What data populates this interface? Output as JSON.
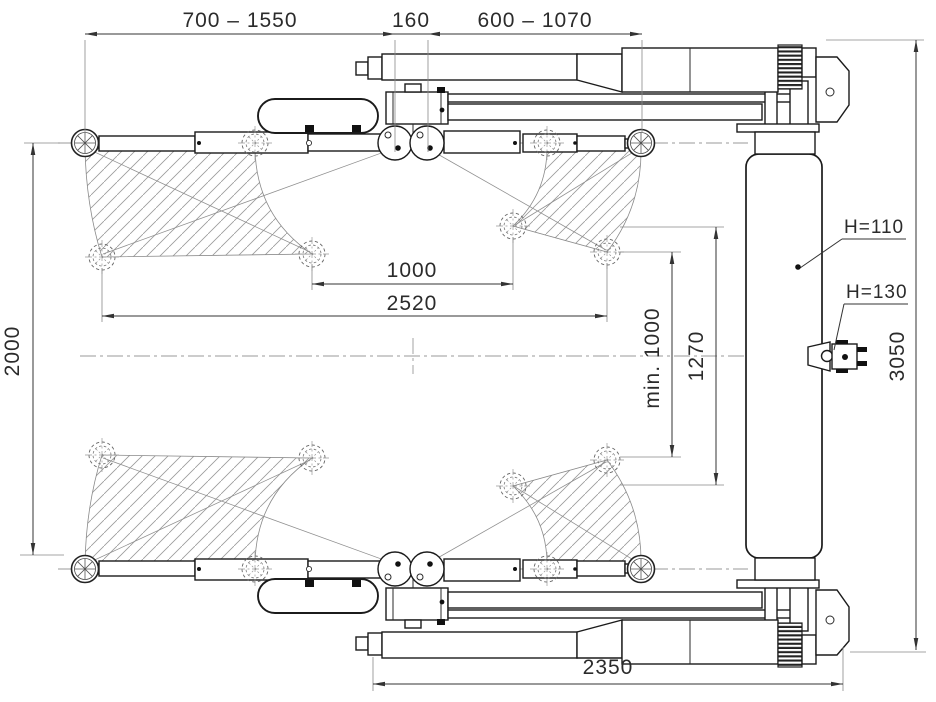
{
  "dimensions": {
    "arm_reach_long": "700 – 1550",
    "pickup_spacing": "160",
    "arm_reach_short": "600 – 1070",
    "pad_span_inner": "1000",
    "pad_span_outer": "2520",
    "swing_width": "2000",
    "min_clearance": "min. 1000",
    "bay_depth": "1270",
    "overall_length": "3050",
    "base_length": "2350"
  },
  "labels": {
    "pad_height_main": "H=110",
    "pad_height_adapter": "H=130"
  }
}
